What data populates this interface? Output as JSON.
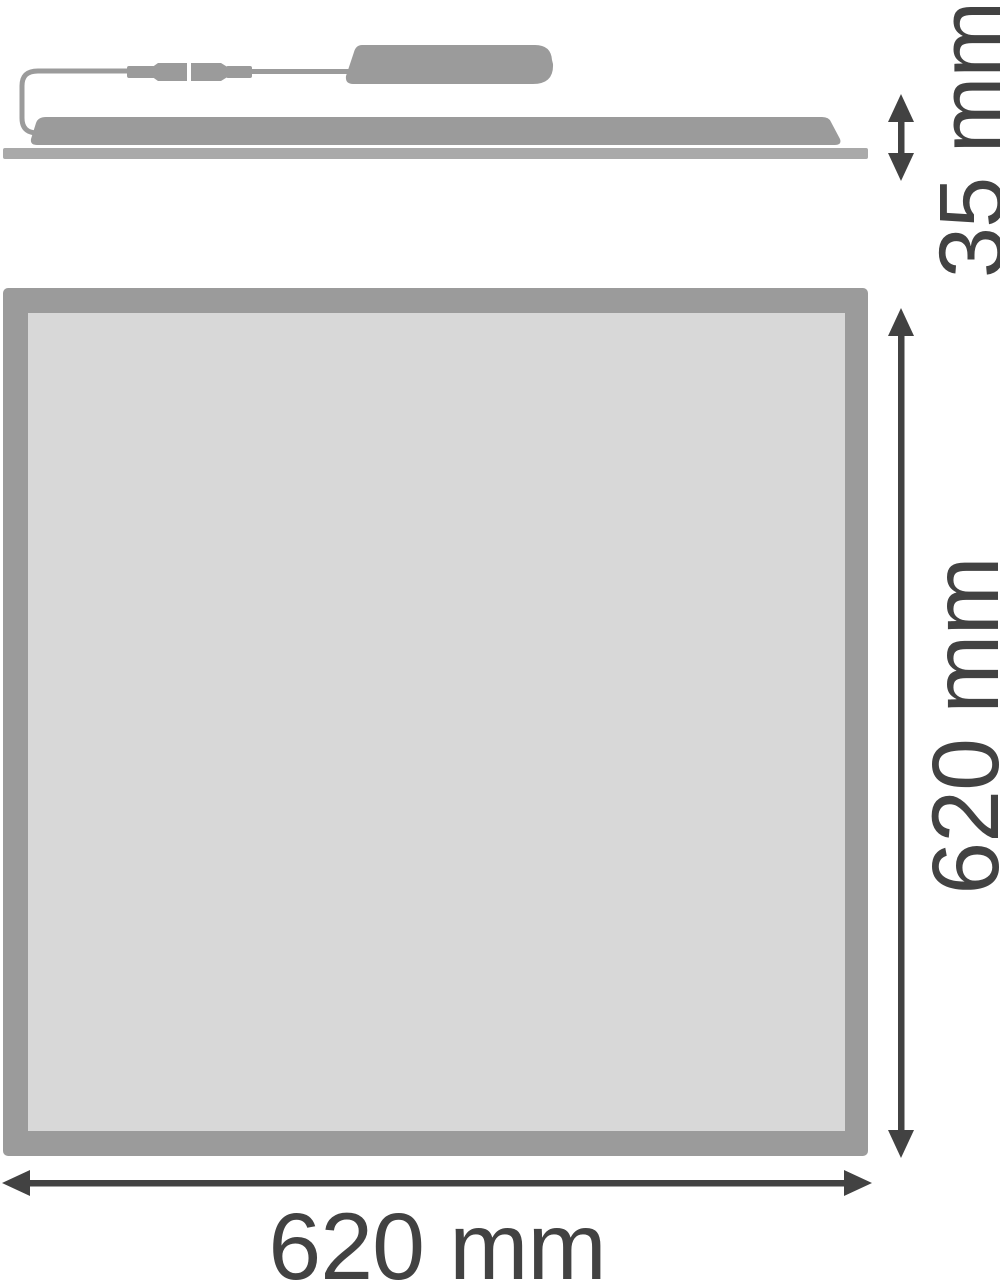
{
  "diagram": {
    "type": "technical-dimension-drawing",
    "subject": "flat LED panel luminaire with remote driver box, side view and front view",
    "views": {
      "side": {
        "depth_label": "35 mm",
        "parts": [
          "baseplate",
          "panel-body",
          "driver-box",
          "connector-pair",
          "cable-loop"
        ]
      },
      "front": {
        "height_label": "620 mm",
        "width_label": "620 mm",
        "parts": [
          "panel-frame",
          "panel-face"
        ]
      }
    },
    "colors": {
      "structure": "#9b9b9b",
      "baseplate": "#a9a9a9",
      "panel_face": "#d8d8d8",
      "dimension": "#424242",
      "background": "#ffffff"
    }
  }
}
